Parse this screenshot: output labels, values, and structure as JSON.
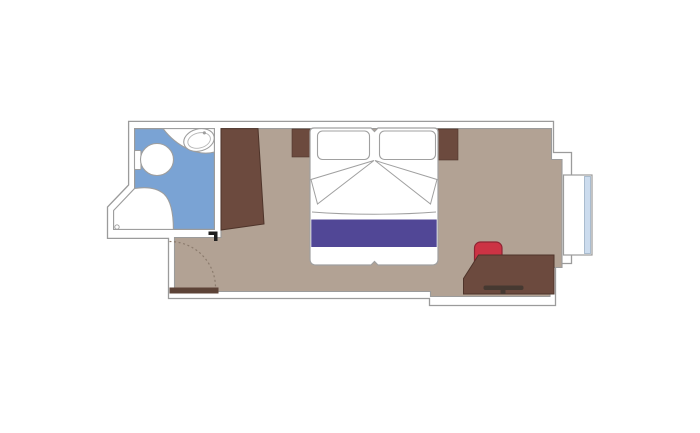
{
  "title": "cruise-cabin-floor-plan",
  "colors": {
    "background": "#ffffff",
    "wall_fill": "#ffffff",
    "wall_line": "#9b9b9b",
    "floor": "#b2a294",
    "floor_line": "#9b9b9b",
    "bathroom_floor": "#7aa3d4",
    "fixture_fill": "#ffffff",
    "fixture_line": "#9e9e9e",
    "fixture_line_light": "#b5b5b5",
    "furniture": "#6c4a3e",
    "furniture_line": "#4e342a",
    "door_wood": "#5d4337",
    "swing_line": "#8b7b6d",
    "door_mark": "#1f1f1f",
    "bed_fill": "#ffffff",
    "bed_line": "#a0a0a0",
    "bed_runner": "#514796",
    "chair": "#cc3344",
    "chair_line": "#8e2433",
    "handle": "#463931",
    "glass": "#ccdcee",
    "glass_line": "#9bb0c4"
  },
  "elements": {
    "plan": "cabin floor plan",
    "bathroom": "bathroom with toilet, sink and shower",
    "toilet": "toilet",
    "sink": "washbasin",
    "shower": "shower tray with drain",
    "wardrobe": "wardrobe",
    "bed": "double bed with two pillows and runner",
    "nightstand_left": "left nightstand",
    "nightstand_right": "right nightstand",
    "desk": "desk with drawer",
    "chair": "red chair",
    "entry_door": "entrance door with swing arc",
    "window": "window / balcony unit"
  }
}
